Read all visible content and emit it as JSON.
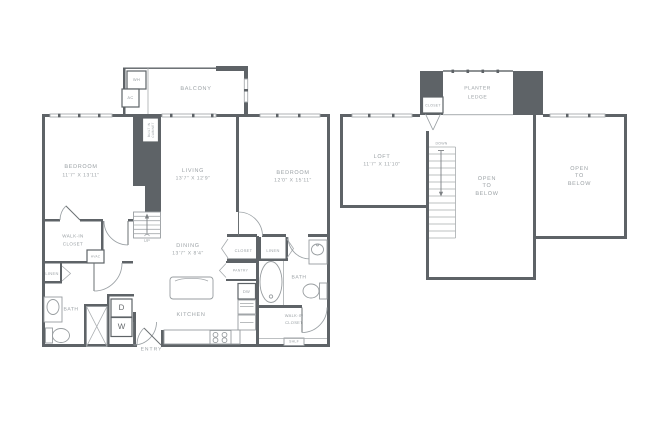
{
  "colors": {
    "wall": "#5e6367",
    "light_line": "#a7abae",
    "fixture": "#989da0",
    "text": "#9aa0a4",
    "background": "#ffffff"
  },
  "floor1": {
    "balcony": "BALCONY",
    "water_heater": "WH",
    "air_conditioner": "AC",
    "built_in_cabinet": "BUILT IN\nCABINET",
    "bedroom_left": {
      "name": "BEDROOM",
      "dims": "11'7\" X 13'11\""
    },
    "living": {
      "name": "LIVING",
      "dims": "13'7\" X 12'9\""
    },
    "bedroom_right": {
      "name": "BEDROOM",
      "dims": "12'0\" X 15'11\""
    },
    "walk_in_closet_left": "WALK-IN\nCLOSET",
    "hvac": "HVAC",
    "linen_left": "LINEN",
    "bath_left": "BATH",
    "dryer": "D",
    "washer": "W",
    "stairs_up": "UP",
    "dining": {
      "name": "DINING",
      "dims": "13'7\" X 8'4\""
    },
    "closet": "CLOSET",
    "linen_right": "LINEN",
    "pantry": "PANTRY",
    "dishwasher": "DW",
    "bath_right": "BATH",
    "kitchen": "KITCHEN",
    "entry": "ENTRY",
    "walk_in_closet_right": "WALK-IN\nCLOSET",
    "shelf": "SHLF"
  },
  "floor2": {
    "planter_ledge": "PLANTER\nLEDGE",
    "closet": "CLOSET",
    "loft": {
      "name": "LOFT",
      "dims": "11'7\" X 11'10\""
    },
    "stairs_down": "DOWN",
    "open_to_below_middle": "OPEN\nTO\nBELOW",
    "open_to_below_right": "OPEN\nTO\nBELOW"
  }
}
